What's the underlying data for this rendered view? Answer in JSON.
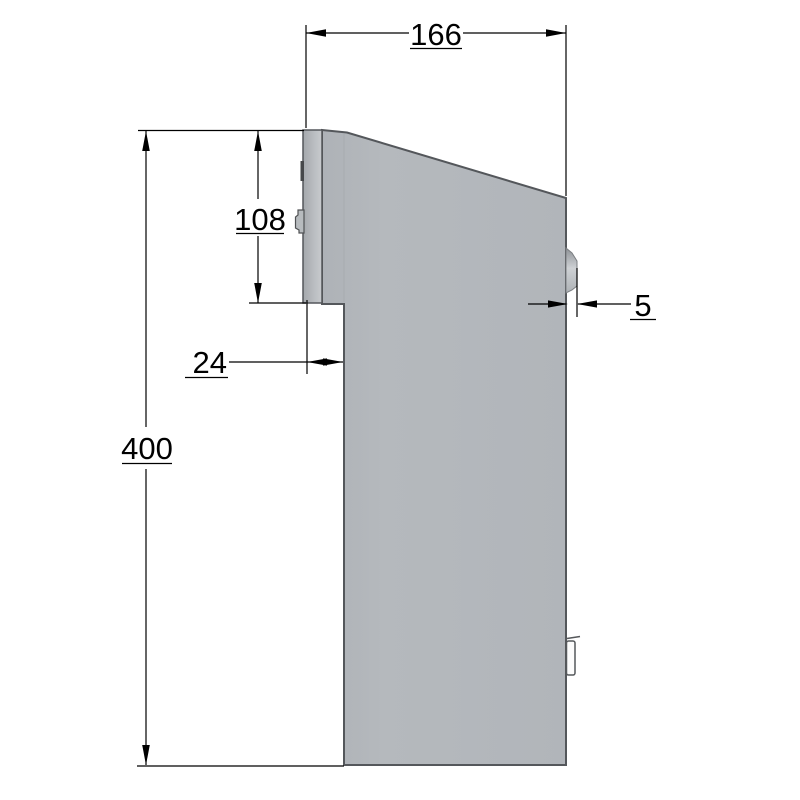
{
  "drawing": {
    "kind": "technical-dimension-side-view",
    "units_hint": "mm",
    "labels": {
      "top_width": "166",
      "front_panel_height": "108",
      "panel_offset_depth": "24",
      "overall_height": "400",
      "lock_protrusion": "5"
    },
    "colors": {
      "background": "#ffffff",
      "body_fill": "#b3b7bb",
      "body_fill_light": "#c8cbce",
      "flange_fill_dark": "#a4a8ac",
      "edge_line": "#54575b",
      "dimension_line": "#000000",
      "slot_mark": "#46484a",
      "latch_fill": "#fcfcfc"
    }
  }
}
